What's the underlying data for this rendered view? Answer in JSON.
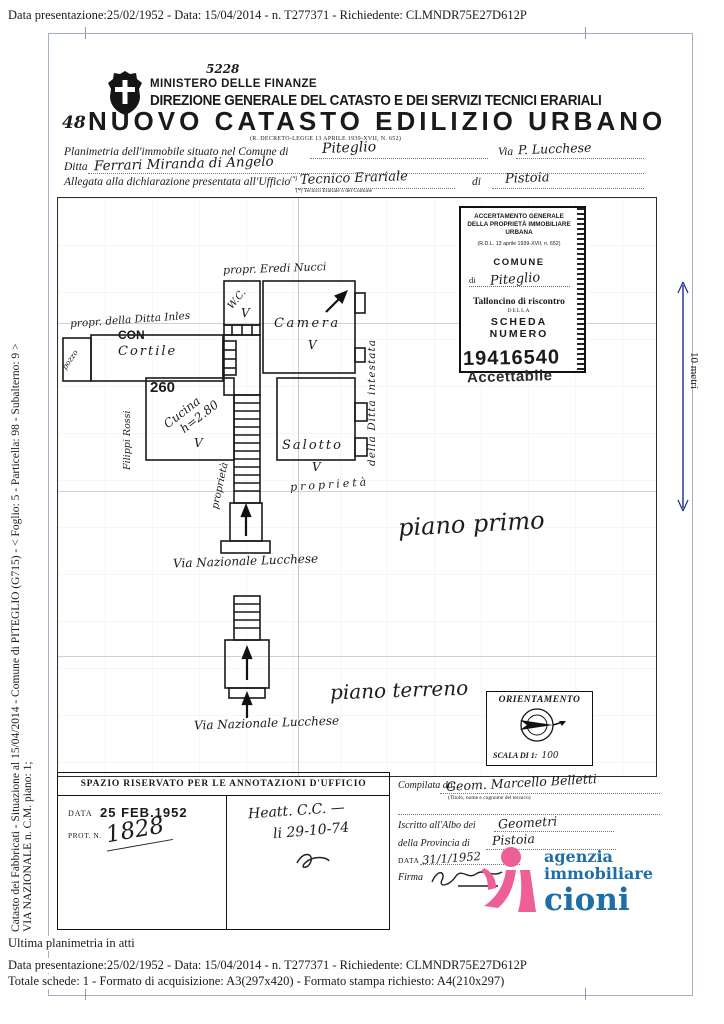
{
  "meta_top": "Data presentazione:25/02/1952 - Data: 15/04/2014 - n. T277371 - Richiedente: CLMNDR75E27D612P",
  "header": {
    "protocol_handwritten": "5228",
    "ministry": "MINISTERO DELLE FINANZE",
    "direzione": "DIREZIONE GENERALE DEL CATASTO E DEI SERVIZI TECNICI ERARIALI",
    "sheet_number": "48",
    "title": "NUOVO CATASTO EDILIZIO URBANO",
    "law_ref": "(R. DECRETO-LEGGE 13 APRILE 1939-XVII, N. 652)"
  },
  "form": {
    "comune_label": "Planimetria dell'immobile situato nel Comune di",
    "comune_value": "Piteglio",
    "via_label": "Via",
    "via_value": "P. Lucchese",
    "ditta_label": "Ditta",
    "ditta_value": "Ferrari Miranda di Angelo",
    "ufficio_label": "Allegata alla dichiarazione presentata all'Ufficio",
    "ufficio_asterisk": "(*)",
    "ufficio_value": "Tecnico Erariale",
    "di_label": "di",
    "di_value": "Pistoia",
    "footnote": "(*) Tecnico Erariale o del Comune"
  },
  "talloncino": {
    "title": "ACCERTAMENTO GENERALE DELLA PROPRIETÀ IMMOBILIARE URBANA",
    "law": "(R.D.L. 13 aprile 1939-XVII, n. 652)",
    "comune_label": "COMUNE",
    "di_label": "di",
    "comune_value": "Piteglio",
    "talloncino_label": "Talloncino di riscontro",
    "della_label": "DELLA",
    "scheda_label": "SCHEDA NUMERO",
    "scheda_value": "19416540",
    "stamp": "Accettabile"
  },
  "plan": {
    "labels": {
      "propr_nucci": "propr. Eredi Nucci",
      "wc": "W.C.",
      "camera": "Camera",
      "propr_ditta": "propr. della Ditta Inles",
      "con_stamp": "CON",
      "cortile": "Cortile",
      "pozzo": "pozzo",
      "room_number": "260",
      "cucina": "Cucina",
      "cucina_h": "h=2.80",
      "salotto": "Salotto",
      "filippi": "Filippi Rossi",
      "proprieta_vert": "proprietà",
      "proprieta": "proprietà",
      "ditta_vert": "della Ditta intestata",
      "piano_primo": "piano primo",
      "via1": "Via Nazionale Lucchese",
      "piano_terreno": "piano terreno",
      "via2": "Via Nazionale Lucchese",
      "check": "V"
    }
  },
  "orientation": {
    "title": "ORIENTAMENTO",
    "scale_label": "SCALA DI 1:",
    "scale_value": "100"
  },
  "annotations": {
    "header": "SPAZIO RISERVATO PER LE ANNOTAZIONI D'UFFICIO",
    "data_label": "DATA",
    "data_stamp": "25 FEB.1952",
    "prot_label": "PROT. N.",
    "prot_value": "1828",
    "note_line1": "Heatt. C.C. —",
    "note_line2": "li 29-10-74"
  },
  "compiler": {
    "compilata_label": "Compilata da:",
    "compilata_value": "Geom. Marcello Belletti",
    "compilata_sub": "(Titolo, nome e cognome del tecnico)",
    "albo_label": "Iscritto all'Albo dei",
    "albo_value": "Geometri",
    "provincia_label": "della Provincia di",
    "provincia_value": "Pistoia",
    "data_label": "DATA",
    "data_value": "31/1/1952",
    "firma_label": "Firma"
  },
  "logo": {
    "line1": "agenzia",
    "line2": "immobiliare",
    "line3": "cioni",
    "pink": "#ee5f97",
    "blue": "#1e6fa9"
  },
  "margins": {
    "left_line1": "Catasto dei Fabbricati - Situazione al 15/04/2014 - Comune di PITEGLIO (G715) - < Foglio: 5 - Particella: 98 - Subalterno: 9 >",
    "left_line2": "VIA NAZIONALE n. C.M. piano: 1;",
    "scale_bar": "10 metri"
  },
  "footer": {
    "line0": "Ultima planimetria in atti",
    "line1": "Data presentazione:25/02/1952 - Data: 15/04/2014 - n. T277371 - Richiedente: CLMNDR75E27D612P",
    "line2": "Totale schede: 1 - Formato di acquisizione: A3(297x420)  - Formato stampa richiesto: A4(210x297)"
  }
}
